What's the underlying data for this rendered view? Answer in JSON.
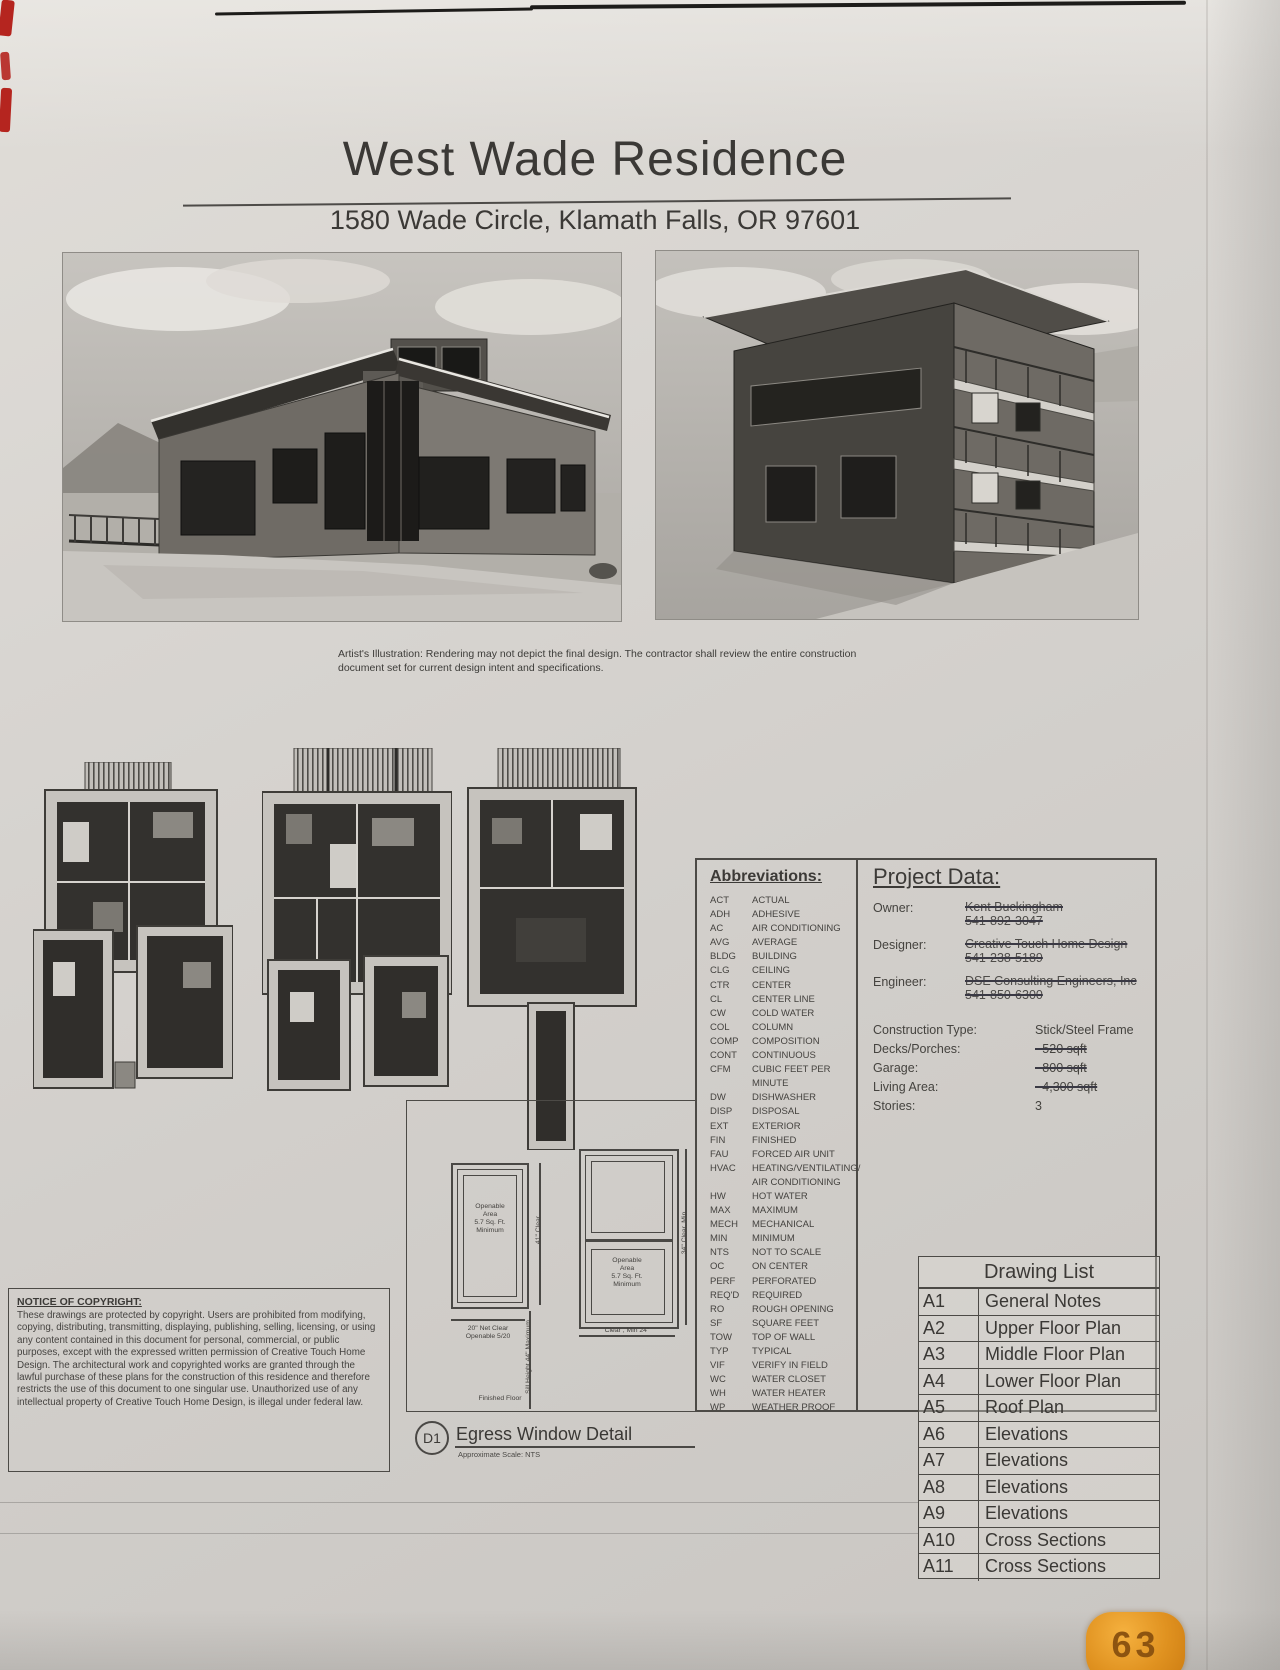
{
  "header": {
    "title": "West Wade Residence",
    "address": "1580 Wade Circle, Klamath Falls, OR 97601"
  },
  "caption": "Artist's Illustration: Rendering may not depict the final design. The contractor shall review the entire construction\ndocument set for current design intent and specifications.",
  "abbreviations": {
    "title": "Abbreviations:",
    "items": [
      {
        "abbr": "ACT",
        "term": "ACTUAL"
      },
      {
        "abbr": "ADH",
        "term": "ADHESIVE"
      },
      {
        "abbr": "AC",
        "term": "AIR CONDITIONING"
      },
      {
        "abbr": "AVG",
        "term": "AVERAGE"
      },
      {
        "abbr": "BLDG",
        "term": "BUILDING"
      },
      {
        "abbr": "CLG",
        "term": "CEILING"
      },
      {
        "abbr": "CTR",
        "term": "CENTER"
      },
      {
        "abbr": "CL",
        "term": "CENTER LINE"
      },
      {
        "abbr": "CW",
        "term": "COLD WATER"
      },
      {
        "abbr": "COL",
        "term": "COLUMN"
      },
      {
        "abbr": "COMP",
        "term": "COMPOSITION"
      },
      {
        "abbr": "CONT",
        "term": "CONTINUOUS"
      },
      {
        "abbr": "CFM",
        "term": "CUBIC FEET PER MINUTE"
      },
      {
        "abbr": "DW",
        "term": "DISHWASHER"
      },
      {
        "abbr": "DISP",
        "term": "DISPOSAL"
      },
      {
        "abbr": "EXT",
        "term": "EXTERIOR"
      },
      {
        "abbr": "FIN",
        "term": "FINISHED"
      },
      {
        "abbr": "FAU",
        "term": "FORCED AIR UNIT"
      },
      {
        "abbr": "HVAC",
        "term": "HEATING/VENTILATING/\nAIR CONDITIONING"
      },
      {
        "abbr": "HW",
        "term": "HOT WATER"
      },
      {
        "abbr": "MAX",
        "term": "MAXIMUM"
      },
      {
        "abbr": "MECH",
        "term": "MECHANICAL"
      },
      {
        "abbr": "MIN",
        "term": "MINIMUM"
      },
      {
        "abbr": "NTS",
        "term": "NOT TO SCALE"
      },
      {
        "abbr": "OC",
        "term": "ON CENTER"
      },
      {
        "abbr": "PERF",
        "term": "PERFORATED"
      },
      {
        "abbr": "REQ'D",
        "term": "REQUIRED"
      },
      {
        "abbr": "RO",
        "term": "ROUGH OPENING"
      },
      {
        "abbr": "SF",
        "term": "SQUARE FEET"
      },
      {
        "abbr": "TOW",
        "term": "TOP OF WALL"
      },
      {
        "abbr": "TYP",
        "term": "TYPICAL"
      },
      {
        "abbr": "VIF",
        "term": "VERIFY IN FIELD"
      },
      {
        "abbr": "WC",
        "term": "WATER CLOSET"
      },
      {
        "abbr": "WH",
        "term": "WATER HEATER"
      },
      {
        "abbr": "WP",
        "term": "WEATHER PROOF"
      }
    ]
  },
  "project_data": {
    "title": "Project Data:",
    "contacts": [
      {
        "label": "Owner:",
        "name": "Kent Buckingham",
        "phone": "541-892-3047"
      },
      {
        "label": "Designer:",
        "name": "Creative Touch Home Design",
        "phone": "541-238-5189"
      },
      {
        "label": "Engineer:",
        "name": "DSE Consulting Engineers, Inc",
        "phone": "541-850-6300"
      }
    ],
    "specs": [
      {
        "label": "Construction Type:",
        "value": "Stick/Steel Frame",
        "struck": false
      },
      {
        "label": "Decks/Porches:",
        "value": "~520 sqft",
        "struck": true
      },
      {
        "label": "Garage:",
        "value": "~800 sqft",
        "struck": true
      },
      {
        "label": "Living Area:",
        "value": "~4,300 sqft",
        "struck": true
      },
      {
        "label": "Stories:",
        "value": "3",
        "struck": false
      }
    ]
  },
  "drawing_list": {
    "title": "Drawing List",
    "rows": [
      [
        "A1",
        "General Notes"
      ],
      [
        "A2",
        "Upper Floor Plan"
      ],
      [
        "A3",
        "Middle Floor Plan"
      ],
      [
        "A4",
        "Lower Floor Plan"
      ],
      [
        "A5",
        "Roof Plan"
      ],
      [
        "A6",
        "Elevations"
      ],
      [
        "A7",
        "Elevations"
      ],
      [
        "A8",
        "Elevations"
      ],
      [
        "A9",
        "Elevations"
      ],
      [
        "A10",
        "Cross Sections"
      ],
      [
        "A11",
        "Cross Sections"
      ]
    ]
  },
  "egress": {
    "bubble": "D1",
    "title": "Egress Window Detail",
    "scale": "Approximate Scale: NTS",
    "left_window_label": "Openable\nArea\n5.7 Sq. Ft.\nMinimum",
    "left_width_dim": "20\" Net Clear\nOpenable 5/20",
    "left_height_dim": "41\" Clear",
    "right_window_label": "Openable\nArea\n5.7 Sq. Ft.\nMinimum",
    "right_width_dim": "Clear , Min 24\"",
    "right_height_dim": "34\" Clear, Min",
    "sill_dim": "Sill Height 44\" Maximum",
    "floor_label": "Finished Floor"
  },
  "copyright": {
    "heading": "NOTICE OF COPYRIGHT:",
    "body": "These drawings are protected by copyright. Users are prohibited from modifying, copying, distributing, transmitting, displaying, publishing, selling, licensing, or using any content contained in this document for personal, commercial, or public purposes, except with the expressed written permission of Creative Touch Home Design. The architectural work and copyrighted works are granted through the lawful purchase of these plans for the construction of this residence and therefore restricts the use of this document to one singular use. Unauthorized use of any intellectual property of Creative Touch Home Design, is illegal under federal law."
  },
  "badge": {
    "text": "63"
  }
}
